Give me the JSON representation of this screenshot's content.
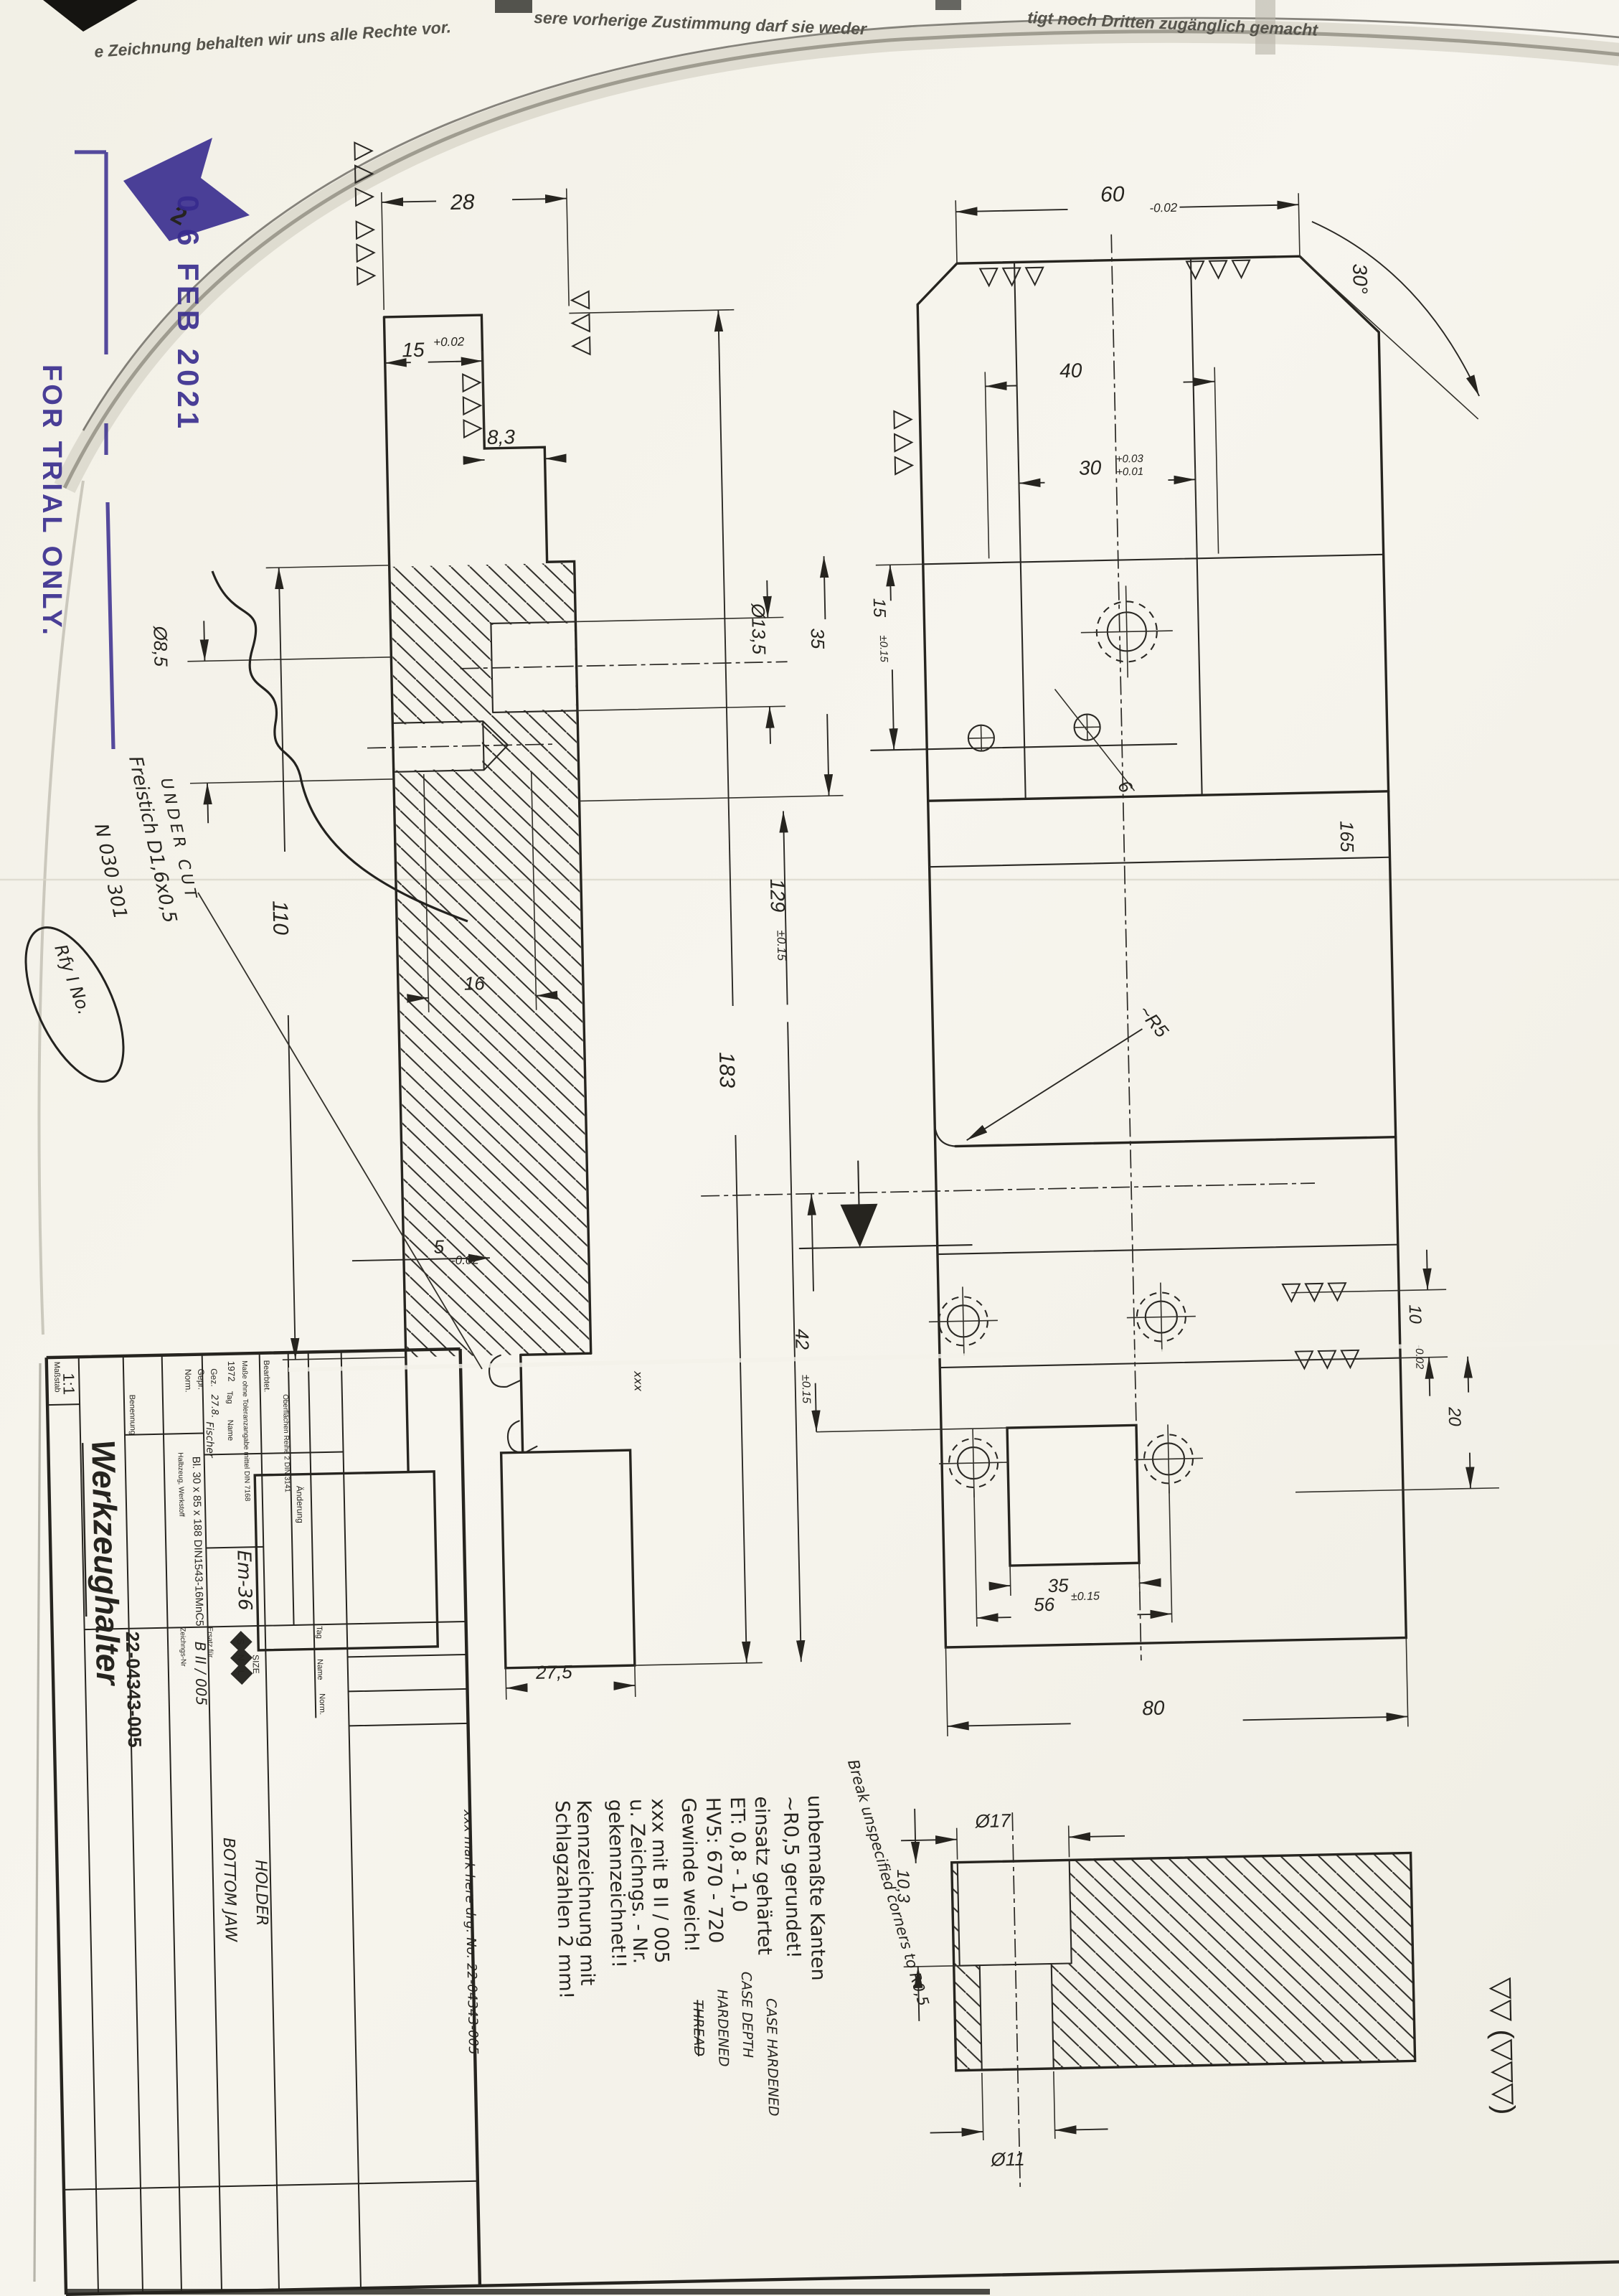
{
  "sheet": {
    "notice1": "e Zeichnung behalten wir uns alle Rechte vor.",
    "notice2": "sere vorherige Zustimmung darf sie weder",
    "notice3": "tigt noch Dritten zugänglich gemacht"
  },
  "stamps": {
    "date": "0 6 FEB 2021",
    "trial": "FOR TRIAL ONLY.",
    "arrow_num": "2"
  },
  "handwriting": {
    "under_cut": "UNDER CUT",
    "freistich": "Freistich D1,6x0,5",
    "n_no": "N 030 301",
    "oval": "Rfy I No.",
    "break_note": "Break unspecified corners to R0,5",
    "mark_note": "xxx mark here drg. No. 22-04343-005",
    "xxx": "xxx"
  },
  "dims": {
    "left": {
      "d28": "28",
      "d15": "15",
      "d15t": "+0.02",
      "d83": "8,3",
      "d135": "Ø13,5",
      "d85": "Ø8,5",
      "d110": "110",
      "d16": "16",
      "d183": "183",
      "d129": "129",
      "d129t": "±0.15",
      "d35": "35",
      "d5": "5",
      "d5t": "-0.02",
      "d275": "27,5"
    },
    "right": {
      "d60": "60",
      "d60t": "-0.02",
      "d40": "40",
      "d30": "30",
      "d30t1": "+0.03",
      "d30t2": "+0.01",
      "d15": "15",
      "d15t": "±0.15",
      "deg30": "30°",
      "d6": "6",
      "dR5": "~R5",
      "d42": "42",
      "d42t": "±0.15",
      "d10": "10",
      "d10t": "-0.02",
      "d20": "20",
      "d35": "35",
      "d56": "56",
      "d56t": "±0.15",
      "d80": "80",
      "d165": "165"
    },
    "detail": {
      "d17": "Ø17",
      "d103": "10,3",
      "d11": "Ø11"
    },
    "surface": "▽▽ (▽▽▽)"
  },
  "notes": {
    "l1": "unbemaßte Kanten",
    "l2": "~R0,5 gerundet!",
    "l3": "einsatz gehärtet",
    "l3e": "CASE HARDENED",
    "l4": "ET: 0,8 - 1,0",
    "l4e": "CASE DEPTH",
    "l5": "HV5: 670 - 720",
    "l5e": "HARDENED",
    "l6": "Gewinde  weich!",
    "l6e": "THREAD",
    "l7": "xxx mit  B II / 005",
    "l8": "u. Zeichngs. - Nr.",
    "l9": "gekennzeichnet!!",
    "l10": "Kennzeichnung  mit",
    "l11": "Schlagzahlen 2 mm!"
  },
  "title_block": {
    "ms_label": "Maßstab",
    "scale": "1:1",
    "ben_label": "Benennung",
    "title": "Werkzeughalter",
    "sub1": "BOTTOM JAW",
    "sub2": "HOLDER",
    "mat_label": "Halbzeug, Werkstoff",
    "material": "Bl. 30 x 85 x 188 DIN1543-16MnC5",
    "em": "Em-36",
    "tol_label": "Maße ohne Toleranzangabe mittel DIN 7168",
    "surf_label": "Oberflächen Reihe 2 DIN 3141",
    "bearb_label": "Bearbtet.",
    "year": "1972",
    "tag": "Tag",
    "name": "Name",
    "gez": "Gez.",
    "gepr": "Gepr.",
    "norm": "Norm.",
    "date_hand": "27.8.",
    "name_hand": "Fischer",
    "aend_label": "Änderung",
    "rev_tag": "Tag",
    "rev_name": "Name",
    "rev_norm": "Norm.",
    "zeich_label": "Zeichngs-Nr",
    "bii": "B II / 005",
    "drawing_no": "22-04343-005",
    "ersatz_label": "Ersatz für",
    "size_label": "SIZE",
    "logo_s": "S",
    "logo_n": "N",
    "logo_l": "L"
  },
  "colors": {
    "ink": "#26241f",
    "stamp": "#372b8e",
    "paper": "#f6f4ec"
  }
}
